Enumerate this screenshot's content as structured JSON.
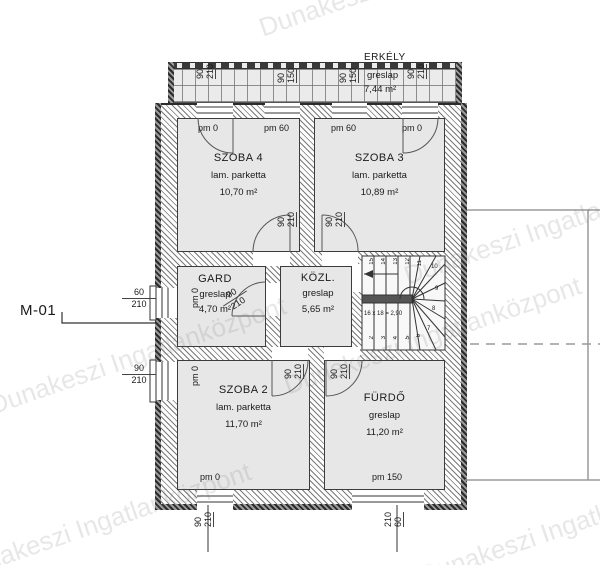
{
  "watermark": "Dunakeszi Ingatlanközpont",
  "plan": {
    "drawing_label": "M-01",
    "balcony": {
      "name": "ERKÉLY",
      "material": "greslap",
      "area": "7,44 m²"
    },
    "rooms": {
      "szoba4": {
        "name": "SZOBA 4",
        "material": "lam. parketta",
        "area": "10,70 m²"
      },
      "szoba3": {
        "name": "SZOBA 3",
        "material": "lam. parketta",
        "area": "10,89 m²"
      },
      "gard": {
        "name": "GARD",
        "material": "greslap",
        "area": "4,70 m²"
      },
      "kozl": {
        "name": "KÖZL.",
        "material": "greslap",
        "area": "5,65 m²"
      },
      "szoba2": {
        "name": "SZOBA 2",
        "material": "lam. parketta",
        "area": "11,70 m²"
      },
      "furdo": {
        "name": "FÜRDŐ",
        "material": "greslap",
        "area": "11,20 m²"
      }
    },
    "parapet": {
      "szoba4_door": "pm 0",
      "szoba4_win": "pm 60",
      "szoba3_win": "pm 60",
      "szoba3_door": "pm 0",
      "gard_side": "pm 0",
      "szoba2_side": "pm 0",
      "szoba2_bottom": "pm 0",
      "furdo_bottom": "pm 150"
    },
    "dims": {
      "balcony_door_l": {
        "w": "90",
        "h": "210"
      },
      "balcony_win_l": {
        "w": "90",
        "h": "150"
      },
      "balcony_win_r": {
        "w": "90",
        "h": "150"
      },
      "balcony_door_r": {
        "w": "90",
        "h": "210"
      },
      "door_szoba4": {
        "w": "90",
        "h": "210"
      },
      "door_szoba3": {
        "w": "90",
        "h": "210"
      },
      "door_gard": {
        "w": "90",
        "h": "210"
      },
      "door_szoba2": {
        "w": "90",
        "h": "210"
      },
      "door_furdo": {
        "w": "90",
        "h": "210"
      },
      "left_win_gard": {
        "w": "60",
        "h": "210"
      },
      "left_win_szoba2": {
        "w": "90",
        "h": "210"
      },
      "bottom_win_szoba2": {
        "w": "90",
        "h": "210"
      },
      "bottom_win_furdo": {
        "w": "210",
        "h": "60"
      }
    },
    "stairs": {
      "formula": "16 x 18 = 2,90",
      "top_numbers": [
        "15",
        "14",
        "13",
        "12",
        "11"
      ],
      "right_numbers": [
        "10",
        "9",
        "8",
        "7"
      ],
      "bottom_numbers": [
        "2",
        "3",
        "4",
        "5",
        "6"
      ]
    }
  }
}
